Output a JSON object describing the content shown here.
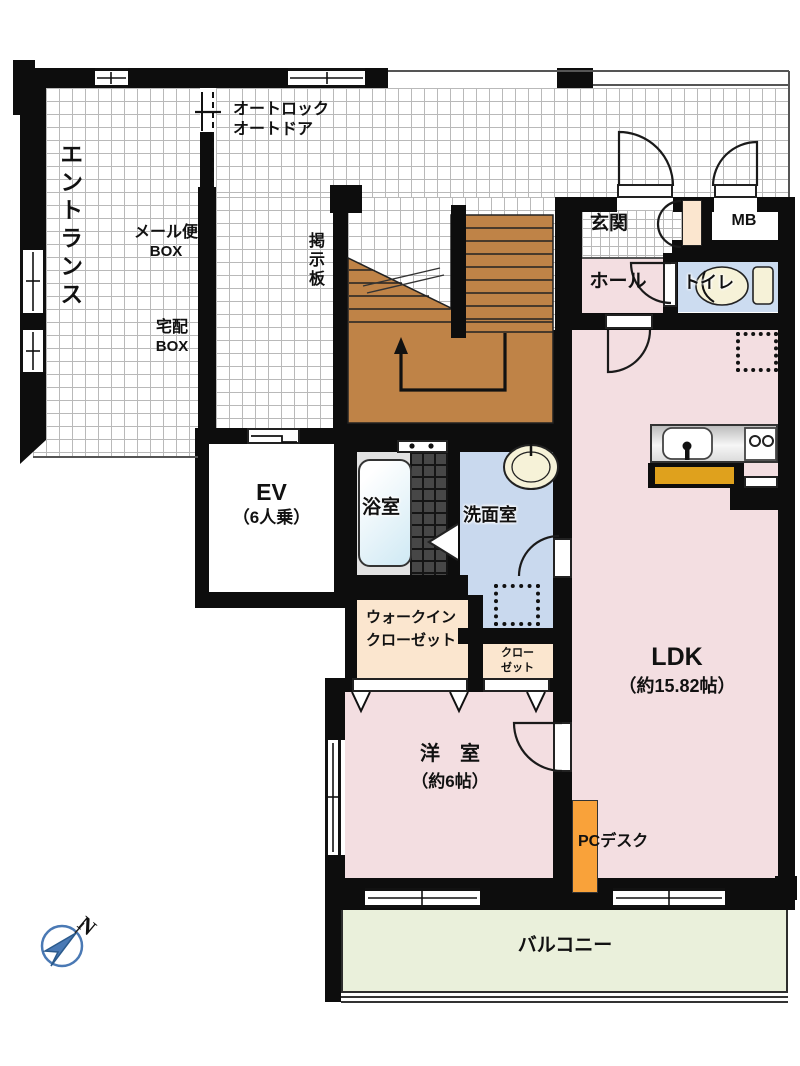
{
  "labels": {
    "entrance": "エントランス",
    "autolock_line1": "オートロック",
    "autolock_line2": "オートドア",
    "mail_line1": "メール便",
    "mail_line2": "BOX",
    "delivery_line1": "宅配",
    "delivery_line2": "BOX",
    "board": "掲示板",
    "genkan": "玄関",
    "mb": "MB",
    "hall": "ホール",
    "toilet": "トイレ",
    "ev_line1": "EV",
    "ev_line2": "（6人乗）",
    "bath": "浴室",
    "washroom": "洗面室",
    "wic_line1": "ウォークイン",
    "wic_line2": "クローゼット",
    "closet_line1": "クロー",
    "closet_line2": "ゼット",
    "ldk_line1": "LDK",
    "ldk_line2": "（約15.82帖）",
    "bedroom_line1": "洋　室",
    "bedroom_line2": "（約6帖）",
    "pc_desk": "PCデスク",
    "balcony": "バルコニー",
    "compass_n": "N"
  },
  "colors": {
    "wall": "#0d0d0d",
    "tileline": "#b9b9b9",
    "pink": "#f3dee1",
    "peach": "#fbe6cf",
    "lblue": "#c9d9ee",
    "tblue": "#ccdcf0",
    "tub": "#cfe9f4",
    "bathfloor": "#474747",
    "stair": "#bf8347",
    "counter_front": "#dfa11d",
    "desk": "#f9a23a",
    "balcony": "#eaf0db",
    "cream": "#f6f2d8",
    "compass": "#4a79b4"
  }
}
